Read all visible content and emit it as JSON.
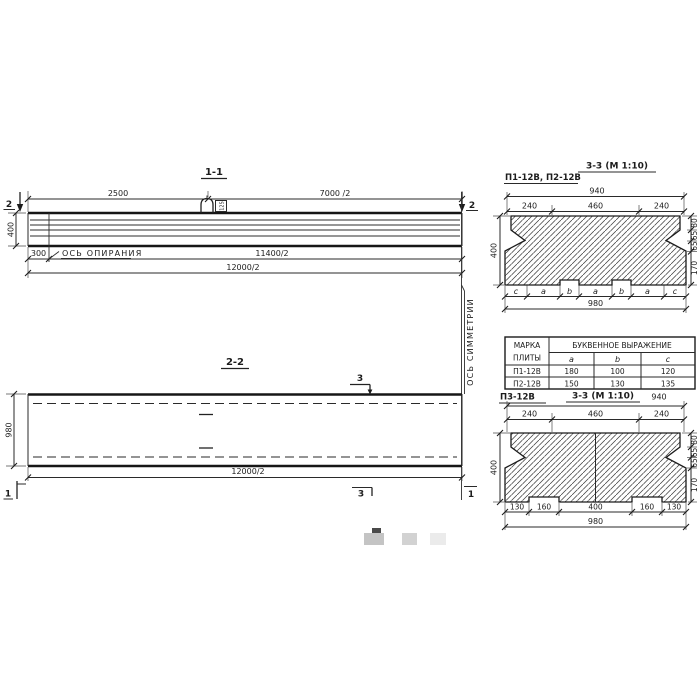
{
  "section11": {
    "title": "1-1",
    "dim_top_left": "2500",
    "dim_top_right": "7000 /2",
    "dim_height": "400",
    "dim_support_offset": "300",
    "dim_lower": "11400/2",
    "dim_total": "12000/2",
    "support_axis_label": "ОСЬ ОПИРАНИЯ",
    "loop_tag": "125",
    "cut_left": "2",
    "cut_right": "2"
  },
  "section22": {
    "title": "2-2",
    "dim_width": "980",
    "dim_total": "12000/2",
    "cut_3_top": "3",
    "cut_3_bottom": "3",
    "cut_1_left": "1",
    "cut_1_right": "1"
  },
  "symmetry_axis_label": "ОСЬ СИММЕТРИИ",
  "section33_top": {
    "title": "3-3 (М 1:10)",
    "label": "П1-12В, П2-12В",
    "dim_940": "940",
    "dim_240_l": "240",
    "dim_460": "460",
    "dim_240_r": "240",
    "dim_400": "400",
    "dim_80": "80",
    "dim_65_a": "65",
    "dim_65_b": "65",
    "dim_170": "170",
    "letters": [
      "c",
      "a",
      "b",
      "a",
      "b",
      "a",
      "c"
    ],
    "dim_980": "980"
  },
  "table": {
    "header_mark_line1": "МАРКА",
    "header_mark_line2": "ПЛИТЫ",
    "header_expr": "БУКВЕННОЕ  ВЫРАЖЕНИЕ",
    "col_a": "a",
    "col_b": "b",
    "col_c": "c",
    "rows": [
      {
        "mark": "П1-12В",
        "a": "180",
        "b": "100",
        "c": "120"
      },
      {
        "mark": "П2-12В",
        "a": "150",
        "b": "130",
        "c": "135"
      }
    ]
  },
  "section33_bottom": {
    "title": "3-3 (М 1:10)",
    "label": "П3-12В",
    "dim_940": "940",
    "dim_240_l": "240",
    "dim_460": "460",
    "dim_240_r": "240",
    "dim_400": "400",
    "dim_80": "80",
    "dim_65_a": "65",
    "dim_65_b": "65",
    "dim_170": "170",
    "dim_130_l": "130",
    "dim_160_l": "160",
    "dim_400_b": "400",
    "dim_160_r": "160",
    "dim_130_r": "130",
    "dim_980": "980"
  }
}
